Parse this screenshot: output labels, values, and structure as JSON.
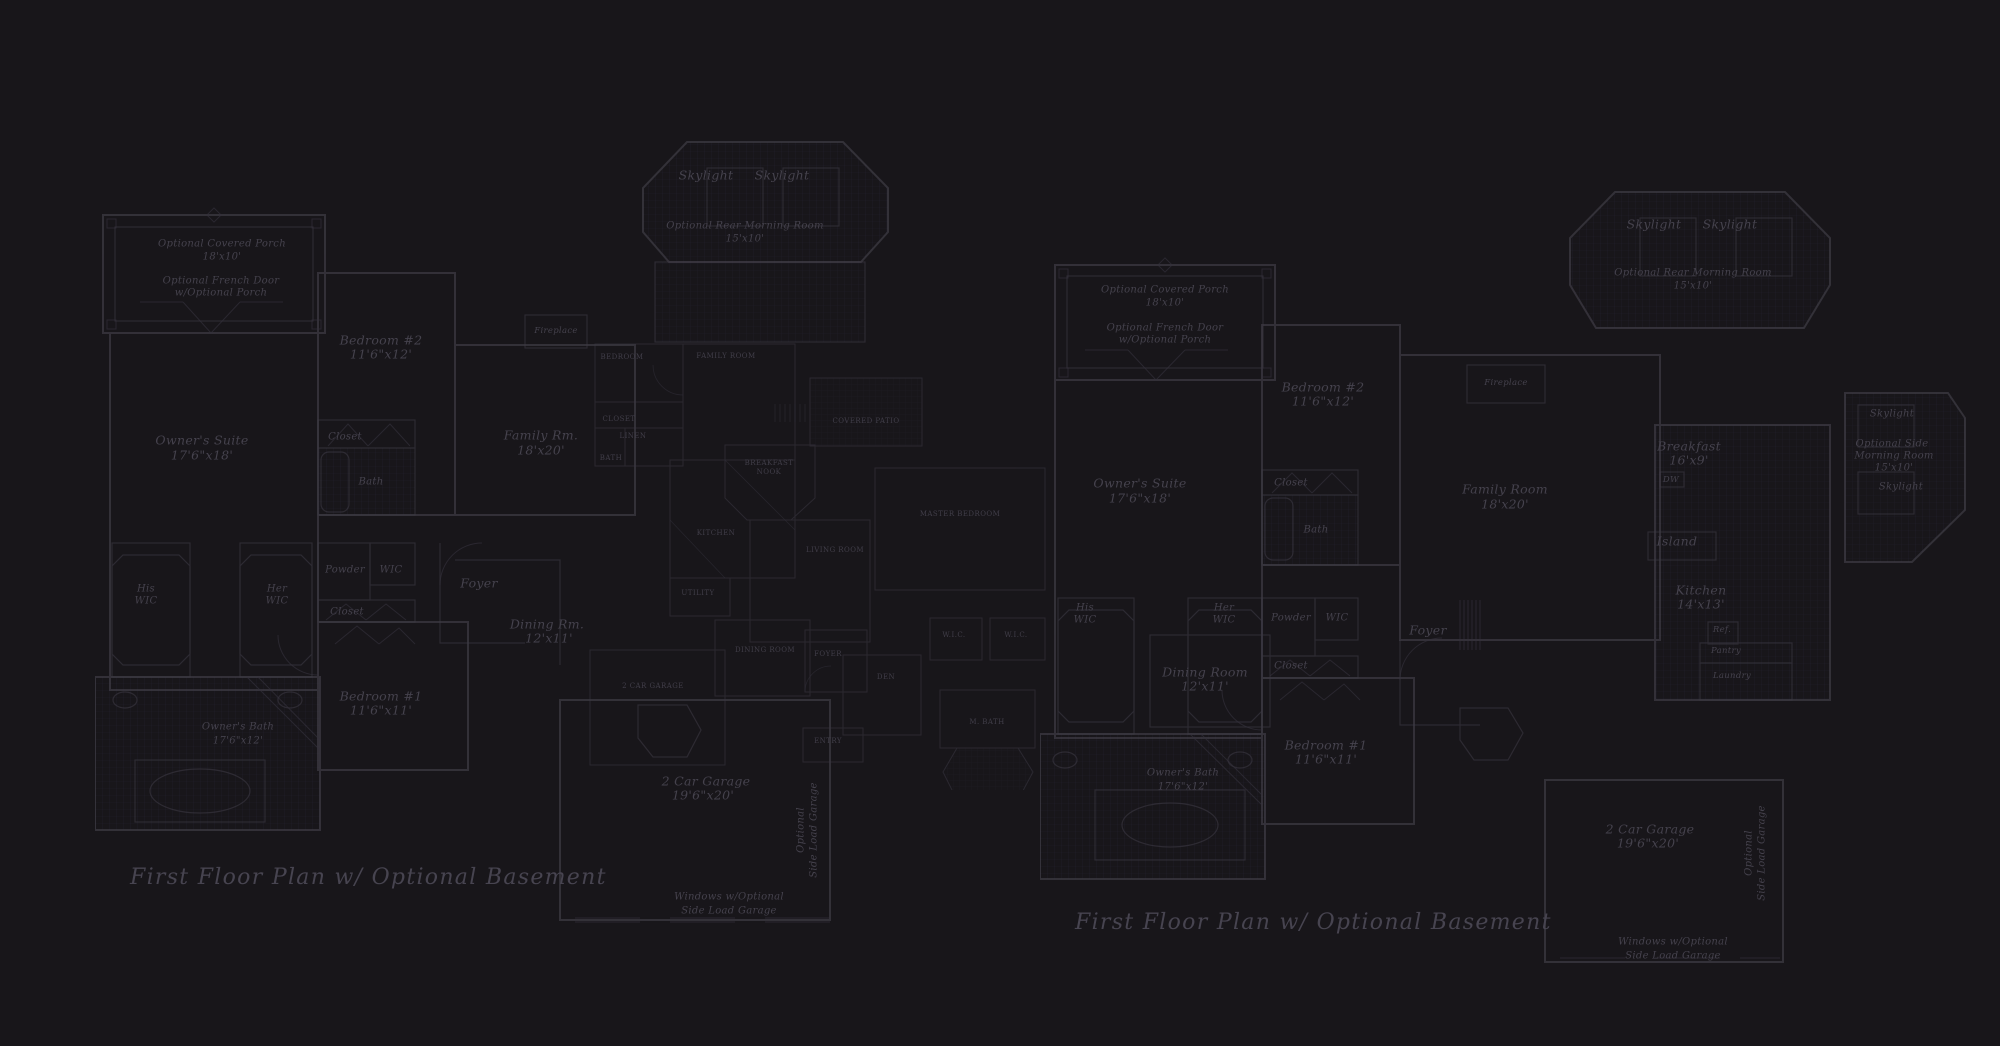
{
  "meta": {
    "drawing_type": "architectural first-floor plans, dark blueprint style"
  },
  "colors": {
    "background": "#18161a",
    "exterior_wall": "#4e4b56",
    "interior_wall": "#3f3c47",
    "fine_line": "#34313c",
    "tile_grid": "#242230",
    "label_text": "#45424d",
    "caps_text": "#413e49",
    "title_text": "#474450"
  },
  "plan_left": {
    "title": "First Floor Plan  w/ Optional Basement",
    "labels": {
      "porch": "Optional Covered Porch",
      "porch_dims": "18'x10'",
      "french_door": "Optional French Door",
      "french_door2": "w/Optional Porch",
      "owners_suite": "Owner's Suite",
      "owners_suite_dims": "17'6\"x18'",
      "bedroom2": "Bedroom #2",
      "bedroom2_dims": "11'6\"x12'",
      "closet": "Closet",
      "bath": "Bath",
      "his": "His",
      "his_wic": "WIC",
      "her": "Her",
      "her_wic": "WIC",
      "powder": "Powder",
      "wic": "WIC",
      "closet2": "Closet",
      "bedroom1": "Bedroom #1",
      "bedroom1_dims": "11'6\"x11'",
      "owners_bath": "Owner's Bath",
      "owners_bath_dims": "17'6\"x12'",
      "foyer": "Foyer",
      "family": "Family Rm.",
      "family_dims": "18'x20'",
      "fireplace": "Fireplace",
      "dining": "Dining Rm.",
      "dining_dims": "12'x11'",
      "skylight_l": "Skylight",
      "skylight_r": "Skylight",
      "morning": "Optional Rear Morning Room",
      "morning_dims": "15'x10'",
      "garage": "2 Car Garage",
      "garage_dims": "19'6\"x20'",
      "sideload1": "Optional",
      "sideload2": "Side Load Garage",
      "windows1": "Windows w/Optional",
      "windows2": "Side Load Garage"
    }
  },
  "plan_small": {
    "labels": {
      "bedroom": "BEDROOM",
      "family_room": "FAMILY ROOM",
      "closet": "CLOSET",
      "linen": "LINEN",
      "bath": "BATH",
      "covered_patio": "COVERED PATIO",
      "breakfast": "BREAKFAST",
      "nook": "NOOK",
      "kitchen": "KITCHEN",
      "utility": "UTILITY",
      "living_room": "LIVING ROOM",
      "master_bedroom": "MASTER BEDROOM",
      "dining_room": "DINING ROOM",
      "foyer": "FOYER",
      "den": "DEN",
      "wic1": "W.I.C.",
      "wic2": "W.I.C.",
      "m_bath": "M. BATH",
      "garage": "2 CAR GARAGE",
      "entry": "ENTRY"
    }
  },
  "plan_right": {
    "title": "First Floor Plan  w/ Optional Basement",
    "labels": {
      "porch": "Optional Covered Porch",
      "porch_dims": "18'x10'",
      "french_door": "Optional French Door",
      "french_door2": "w/Optional Porch",
      "owners_suite": "Owner's Suite",
      "owners_suite_dims": "17'6\"x18'",
      "bedroom2": "Bedroom #2",
      "bedroom2_dims": "11'6\"x12'",
      "closet": "Closet",
      "bath": "Bath",
      "family": "Family Room",
      "family_dims": "18'x20'",
      "fireplace": "Fireplace",
      "skylight_l": "Skylight",
      "skylight_r": "Skylight",
      "morning": "Optional Rear Morning Room",
      "morning_dims": "15'x10'",
      "breakfast": "Breakfast",
      "breakfast_dims": "16'x9'",
      "dw": "DW",
      "island": "Island",
      "kitchen": "Kitchen",
      "kitchen_dims": "14'x13'",
      "ref": "Ref.",
      "pantry": "Pantry",
      "laundry": "Laundry",
      "skylight_top": "Skylight",
      "side_morning1": "Optional Side",
      "side_morning2": "Morning Room",
      "side_morning_dims": "15'x10'",
      "skylight_side": "Skylight",
      "powder": "Powder",
      "wic": "WIC",
      "closet2": "Closet",
      "his": "His",
      "his_wic": "WIC",
      "her": "Her",
      "her_wic": "WIC",
      "foyer": "Foyer",
      "dining": "Dining Room",
      "dining_dims": "12'x11'",
      "bedroom1": "Bedroom #1",
      "bedroom1_dims": "11'6\"x11'",
      "owners_bath": "Owner's Bath",
      "owners_bath_dims": "17'6\"x12'",
      "garage": "2 Car Garage",
      "garage_dims": "19'6\"x20'",
      "sideload1": "Optional",
      "sideload2": "Side Load Garage",
      "windows1": "Windows w/Optional",
      "windows2": "Side Load Garage"
    }
  }
}
